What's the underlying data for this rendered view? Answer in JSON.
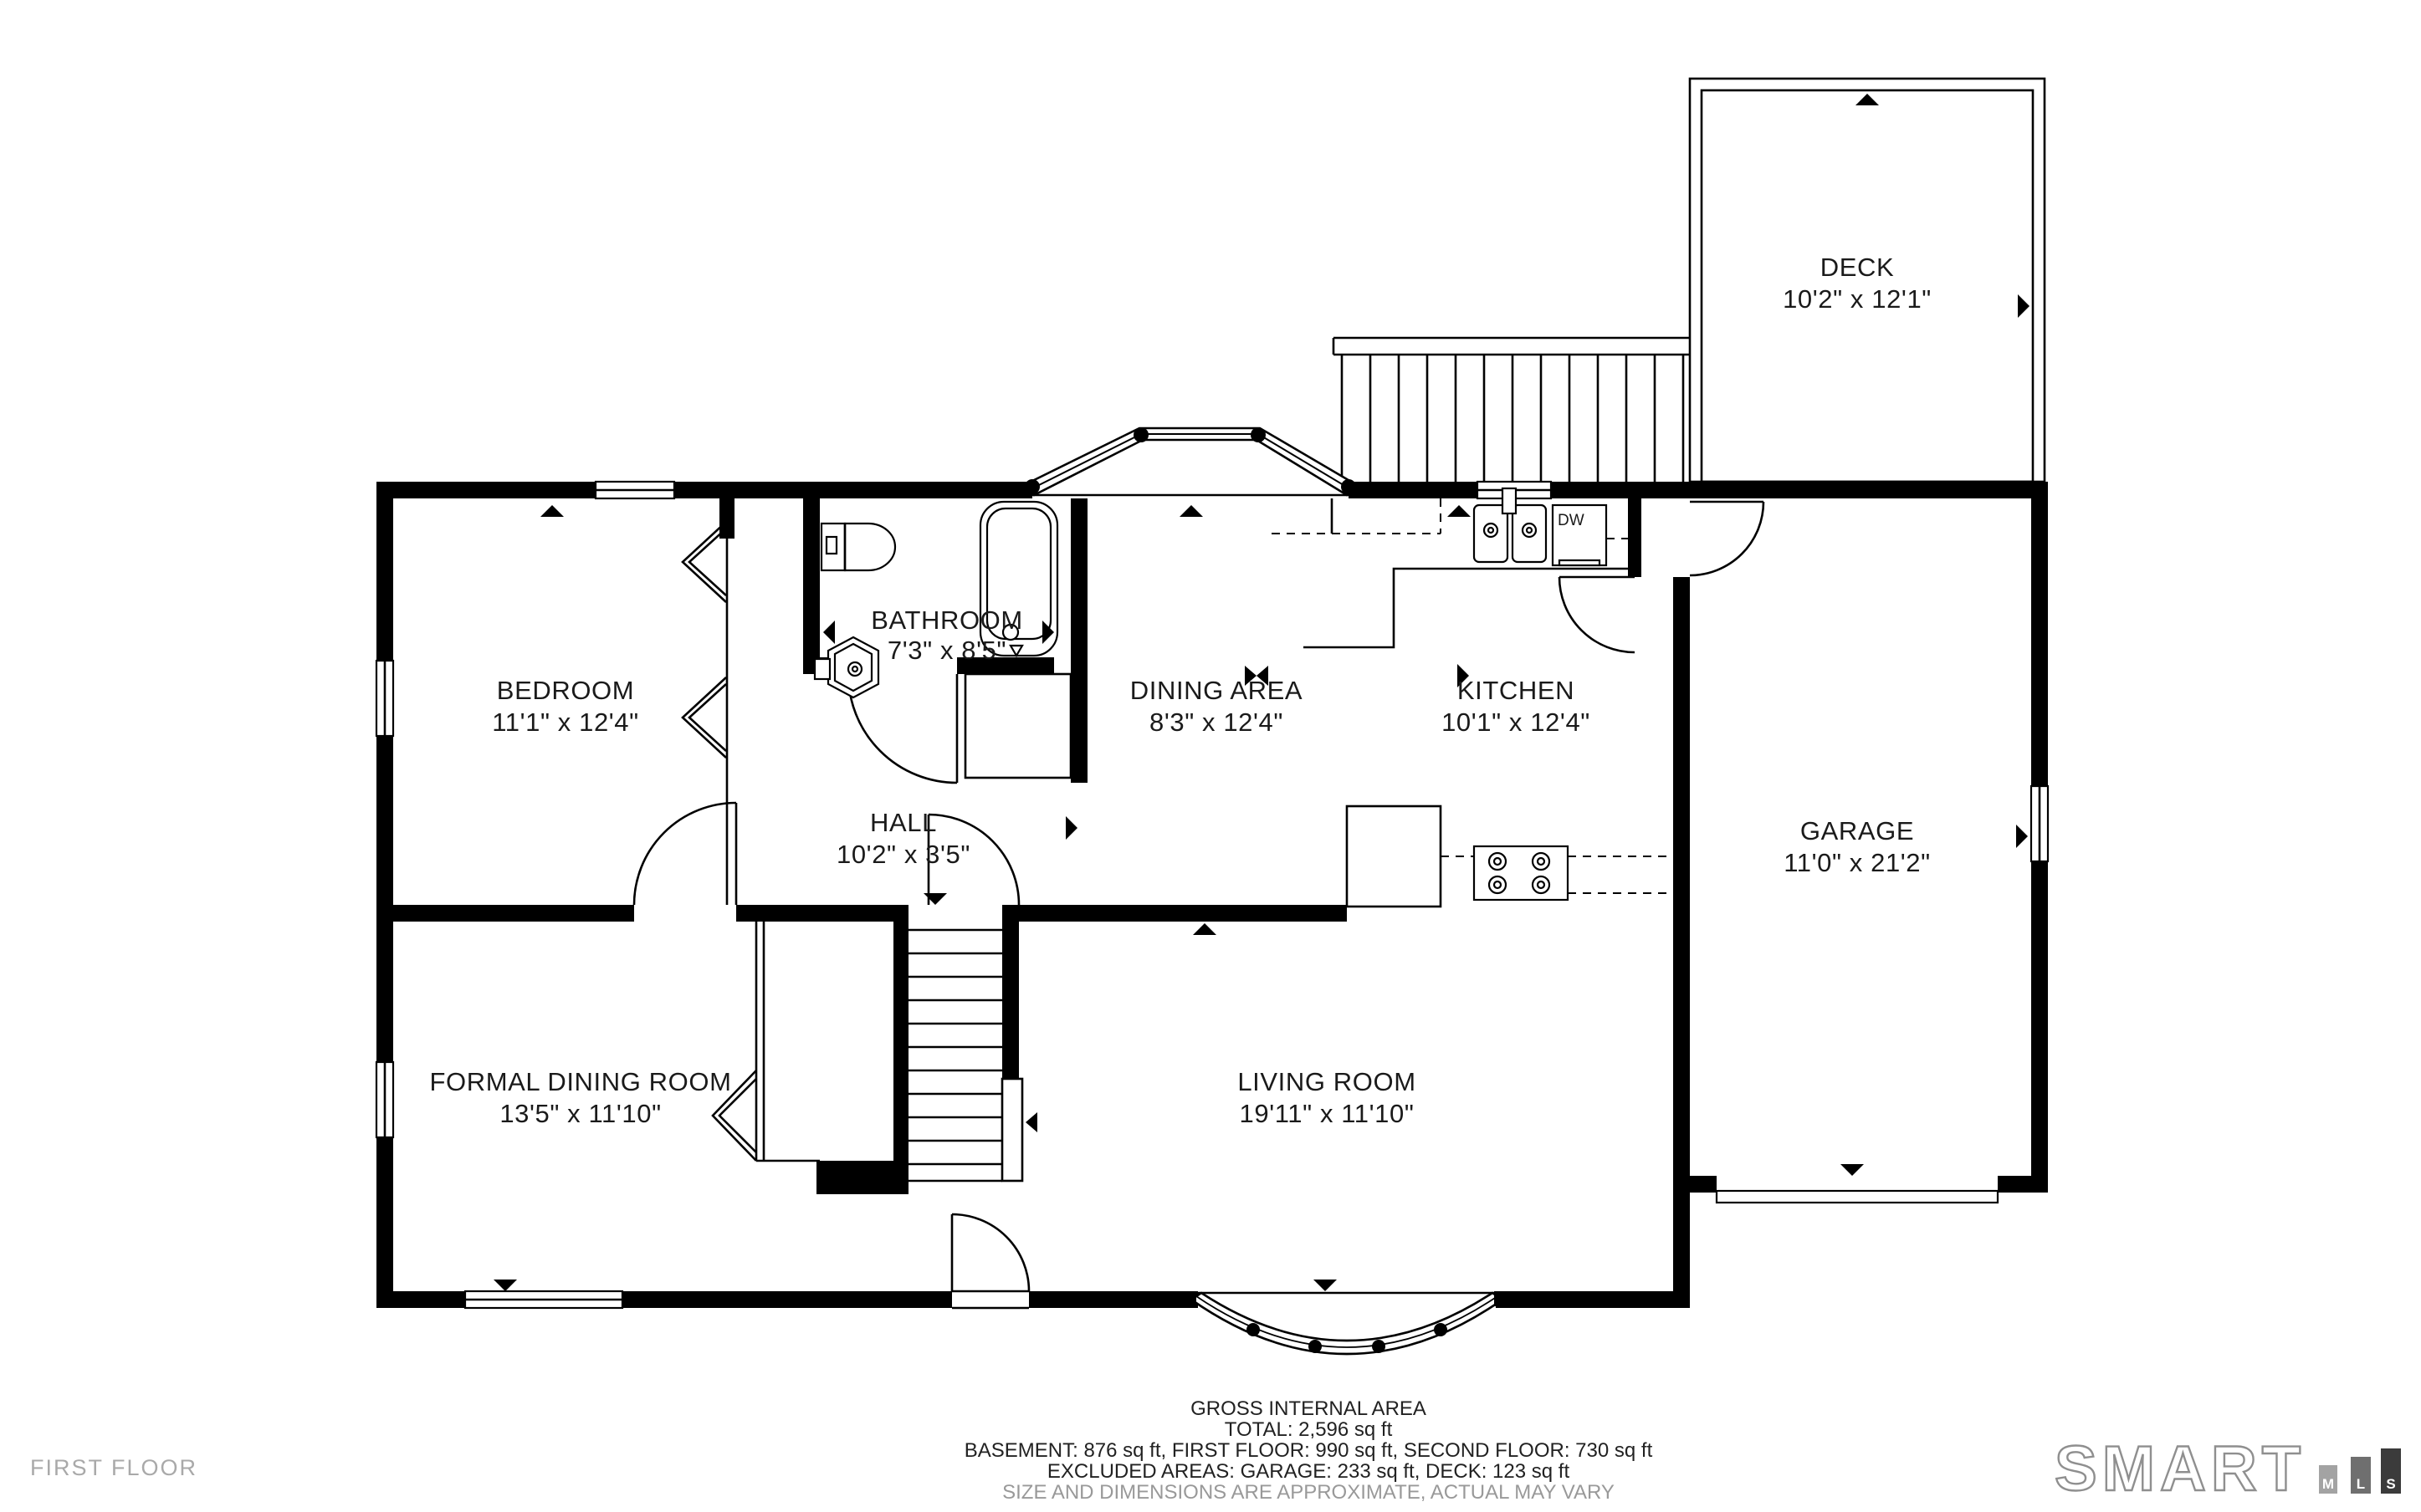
{
  "page": {
    "floor_label": "FIRST FLOOR"
  },
  "rooms": {
    "deck": {
      "name": "DECK",
      "dims": "10'2\" x 12'1\""
    },
    "bedroom": {
      "name": "BEDROOM",
      "dims": "11'1\" x 12'4\""
    },
    "bathroom": {
      "name": "BATHROOM",
      "dims": "7'3\" x 8'5\""
    },
    "dining_area": {
      "name": "DINING AREA",
      "dims": "8'3\" x 12'4\""
    },
    "kitchen": {
      "name": "KITCHEN",
      "dims": "10'1\" x 12'4\""
    },
    "garage": {
      "name": "GARAGE",
      "dims": "11'0\" x 21'2\""
    },
    "hall": {
      "name": "HALL",
      "dims": "10'2\" x 3'5\""
    },
    "formal_dining_room": {
      "name": "FORMAL DINING ROOM",
      "dims": "13'5\" x 11'10\""
    },
    "living_room": {
      "name": "LIVING ROOM",
      "dims": "19'11\" x 11'10\""
    }
  },
  "fixtures": {
    "dishwasher_label": "DW"
  },
  "footer": {
    "title": "GROSS INTERNAL AREA",
    "total": "TOTAL: 2,596 sq ft",
    "floors": "BASEMENT: 876 sq ft, FIRST FLOOR: 990 sq ft, SECOND FLOOR: 730 sq ft",
    "excluded": "EXCLUDED AREAS: GARAGE: 233 sq ft, DECK: 123 sq ft",
    "disclaimer": "SIZE AND DIMENSIONS ARE APPROXIMATE, ACTUAL MAY VARY"
  },
  "branding": {
    "word": "SMART",
    "bars": [
      {
        "letter": "M",
        "color": "#a3a3a3"
      },
      {
        "letter": "L",
        "color": "#6f6f6f"
      },
      {
        "letter": "S",
        "color": "#3b3b3b"
      }
    ]
  },
  "colors": {
    "walls": "#000000",
    "background": "#ffffff",
    "label_text": "#1a1a1a",
    "muted_text": "#999999",
    "floor_label_text": "#a9a9a9",
    "logo_outline": "#8f8f8f"
  }
}
